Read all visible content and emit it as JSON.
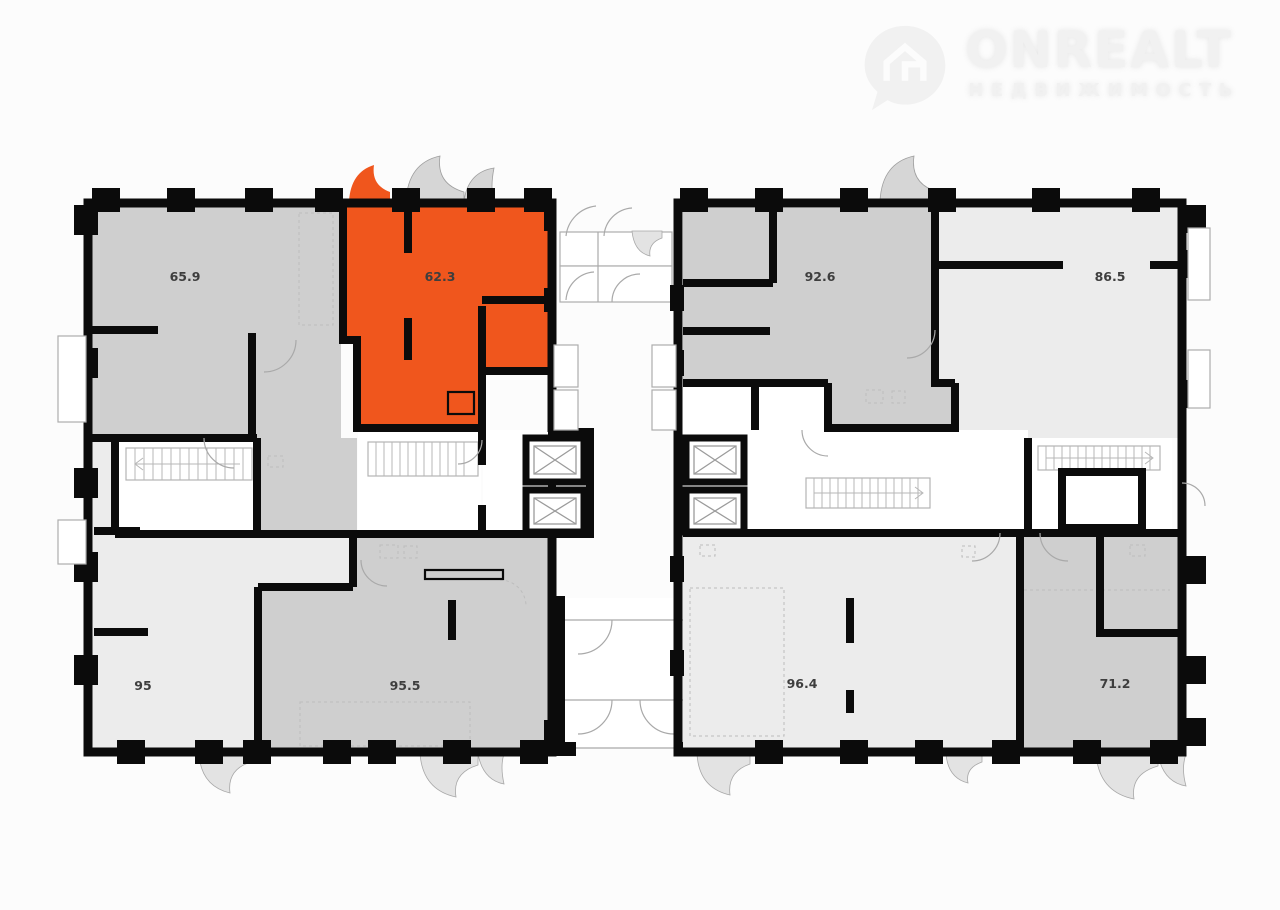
{
  "logo": {
    "brand": "ONREALT",
    "tagline": "НЕДВИЖИМОСТЬ",
    "icon": "house-pin-icon"
  },
  "colors": {
    "background": "#FCFCFC",
    "wall": "#0B0B0B",
    "highlight": "#F0561D",
    "unit_gray": "#CFCFCF",
    "unit_light": "#ECECEC",
    "outline": "#A9A9A9",
    "balcony_fill": "#D6D6D6",
    "label": "#3E3E3E",
    "logo": "#F1F1F1"
  },
  "plan": {
    "left_block": {
      "name": "left building section",
      "units": [
        {
          "area_label": "65.9",
          "shade": "gray",
          "highlighted": false,
          "position": "top-left"
        },
        {
          "area_label": "62.3",
          "shade": "highlight",
          "highlighted": true,
          "position": "top-right"
        },
        {
          "area_label": "95",
          "shade": "light",
          "highlighted": false,
          "position": "bottom-left"
        },
        {
          "area_label": "95.5",
          "shade": "gray",
          "highlighted": false,
          "position": "bottom-right"
        }
      ]
    },
    "right_block": {
      "name": "right building section",
      "units": [
        {
          "area_label": "92.6",
          "shade": "gray",
          "highlighted": false,
          "position": "top-left"
        },
        {
          "area_label": "86.5",
          "shade": "light",
          "highlighted": false,
          "position": "top-right"
        },
        {
          "area_label": "96.4",
          "shade": "light",
          "highlighted": false,
          "position": "bottom-left"
        },
        {
          "area_label": "71.2",
          "shade": "gray",
          "highlighted": false,
          "position": "bottom-right"
        }
      ]
    },
    "symbols": {
      "elevator": "elevator-shaft-icon",
      "stairs": "staircase-icon"
    }
  }
}
